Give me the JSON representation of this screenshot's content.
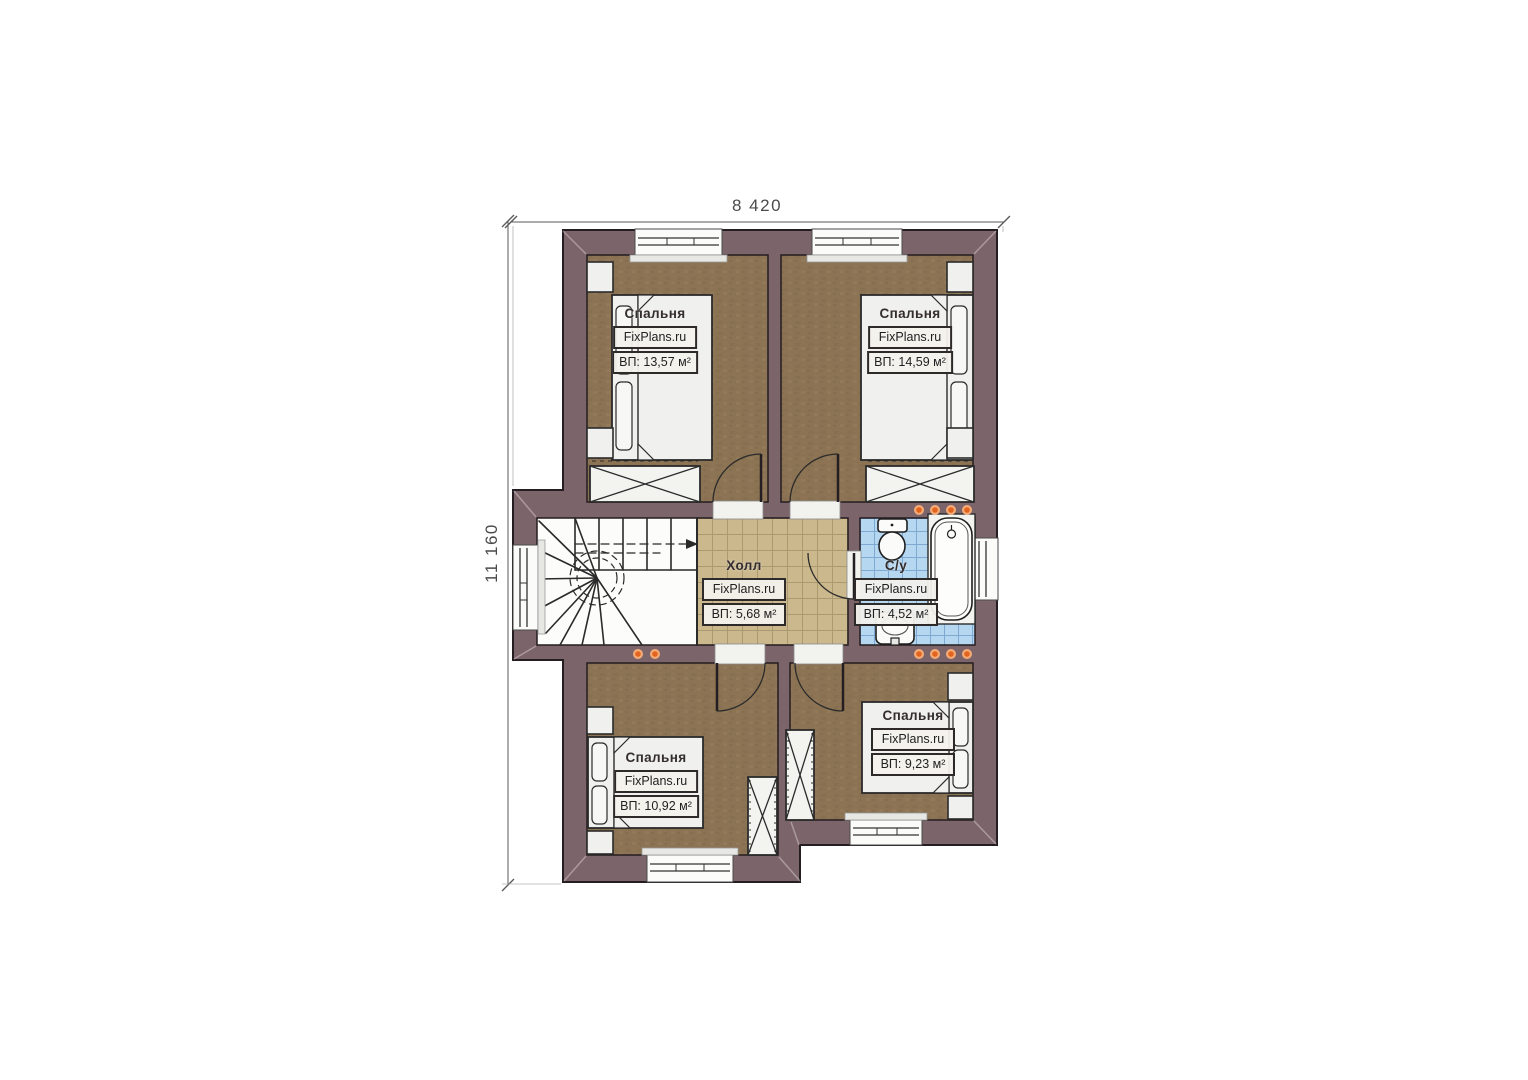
{
  "dimensions": {
    "width": "8 420",
    "height": "11 160"
  },
  "rooms": [
    {
      "key": "bedroom-top-left",
      "name": "Спальня",
      "brand": "FixPlans.ru",
      "area": "ВП: 13,57 м²"
    },
    {
      "key": "bedroom-top-right",
      "name": "Спальня",
      "brand": "FixPlans.ru",
      "area": "ВП: 14,59 м²"
    },
    {
      "key": "hall",
      "name": "Холл",
      "brand": "FixPlans.ru",
      "area": "ВП: 5,68 м²"
    },
    {
      "key": "bathroom",
      "name": "С/у",
      "brand": "FixPlans.ru",
      "area": "ВП: 4,52 м²"
    },
    {
      "key": "bedroom-bottom-left",
      "name": "Спальня",
      "brand": "FixPlans.ru",
      "area": "ВП: 10,92 м²"
    },
    {
      "key": "bedroom-bottom-right",
      "name": "Спальня",
      "brand": "FixPlans.ru",
      "area": "ВП: 9,23 м²"
    }
  ],
  "colors": {
    "wall": "#7c656a",
    "bedroom_floor": "#8b7354",
    "hall_tile": "#ccb88d",
    "bath_tile": "#b5d7f0",
    "light_accent": "#e2641f"
  }
}
